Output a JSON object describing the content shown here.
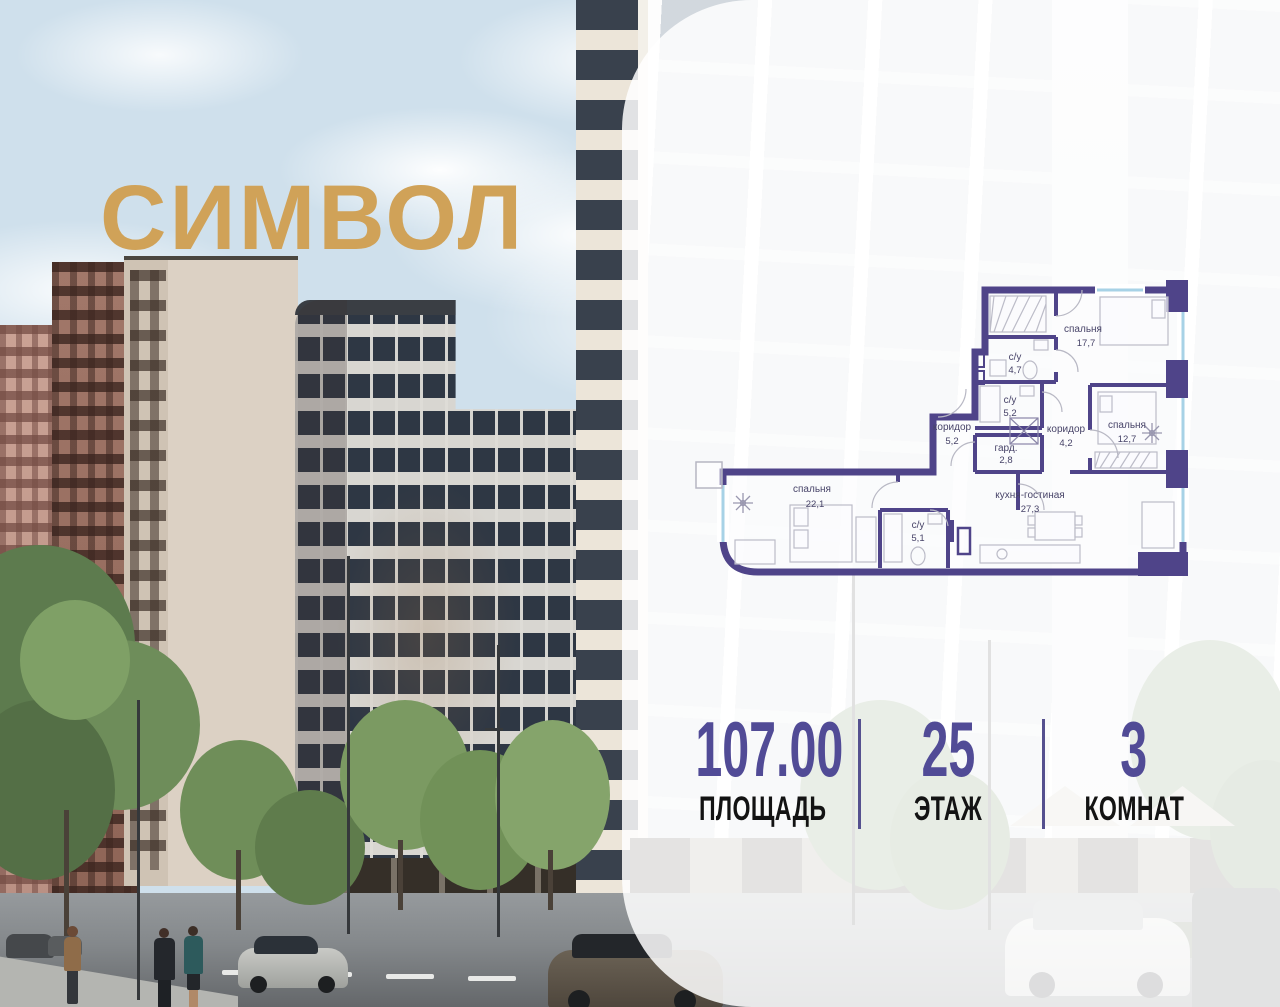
{
  "brand": {
    "logo_text": "СИМВОЛ",
    "logo_color": "#d0a258"
  },
  "floor_plan": {
    "wall_color": "#4f4489",
    "window_color": "#a7d2e6",
    "rooms": [
      {
        "name": "спальня",
        "area": "17,7"
      },
      {
        "name": "с/у",
        "area": "4,7"
      },
      {
        "name": "с/у",
        "area": "5,2"
      },
      {
        "name": "коридор",
        "area": "5,2"
      },
      {
        "name": "гард.",
        "area": "2,8"
      },
      {
        "name": "коридор",
        "area": "4,2"
      },
      {
        "name": "спальня",
        "area": "12,7"
      },
      {
        "name": "спальня",
        "area": "22,1"
      },
      {
        "name": "кухня-гостиная",
        "area": "27,3"
      },
      {
        "name": "с/у",
        "area": "5,1"
      }
    ]
  },
  "stats": {
    "value_color": "#514b96",
    "items": [
      {
        "value": "107.00",
        "label": "ПЛОЩАДЬ"
      },
      {
        "value": "25",
        "label": "ЭТАЖ"
      },
      {
        "value": "3",
        "label": "КОМНАТ"
      }
    ]
  }
}
